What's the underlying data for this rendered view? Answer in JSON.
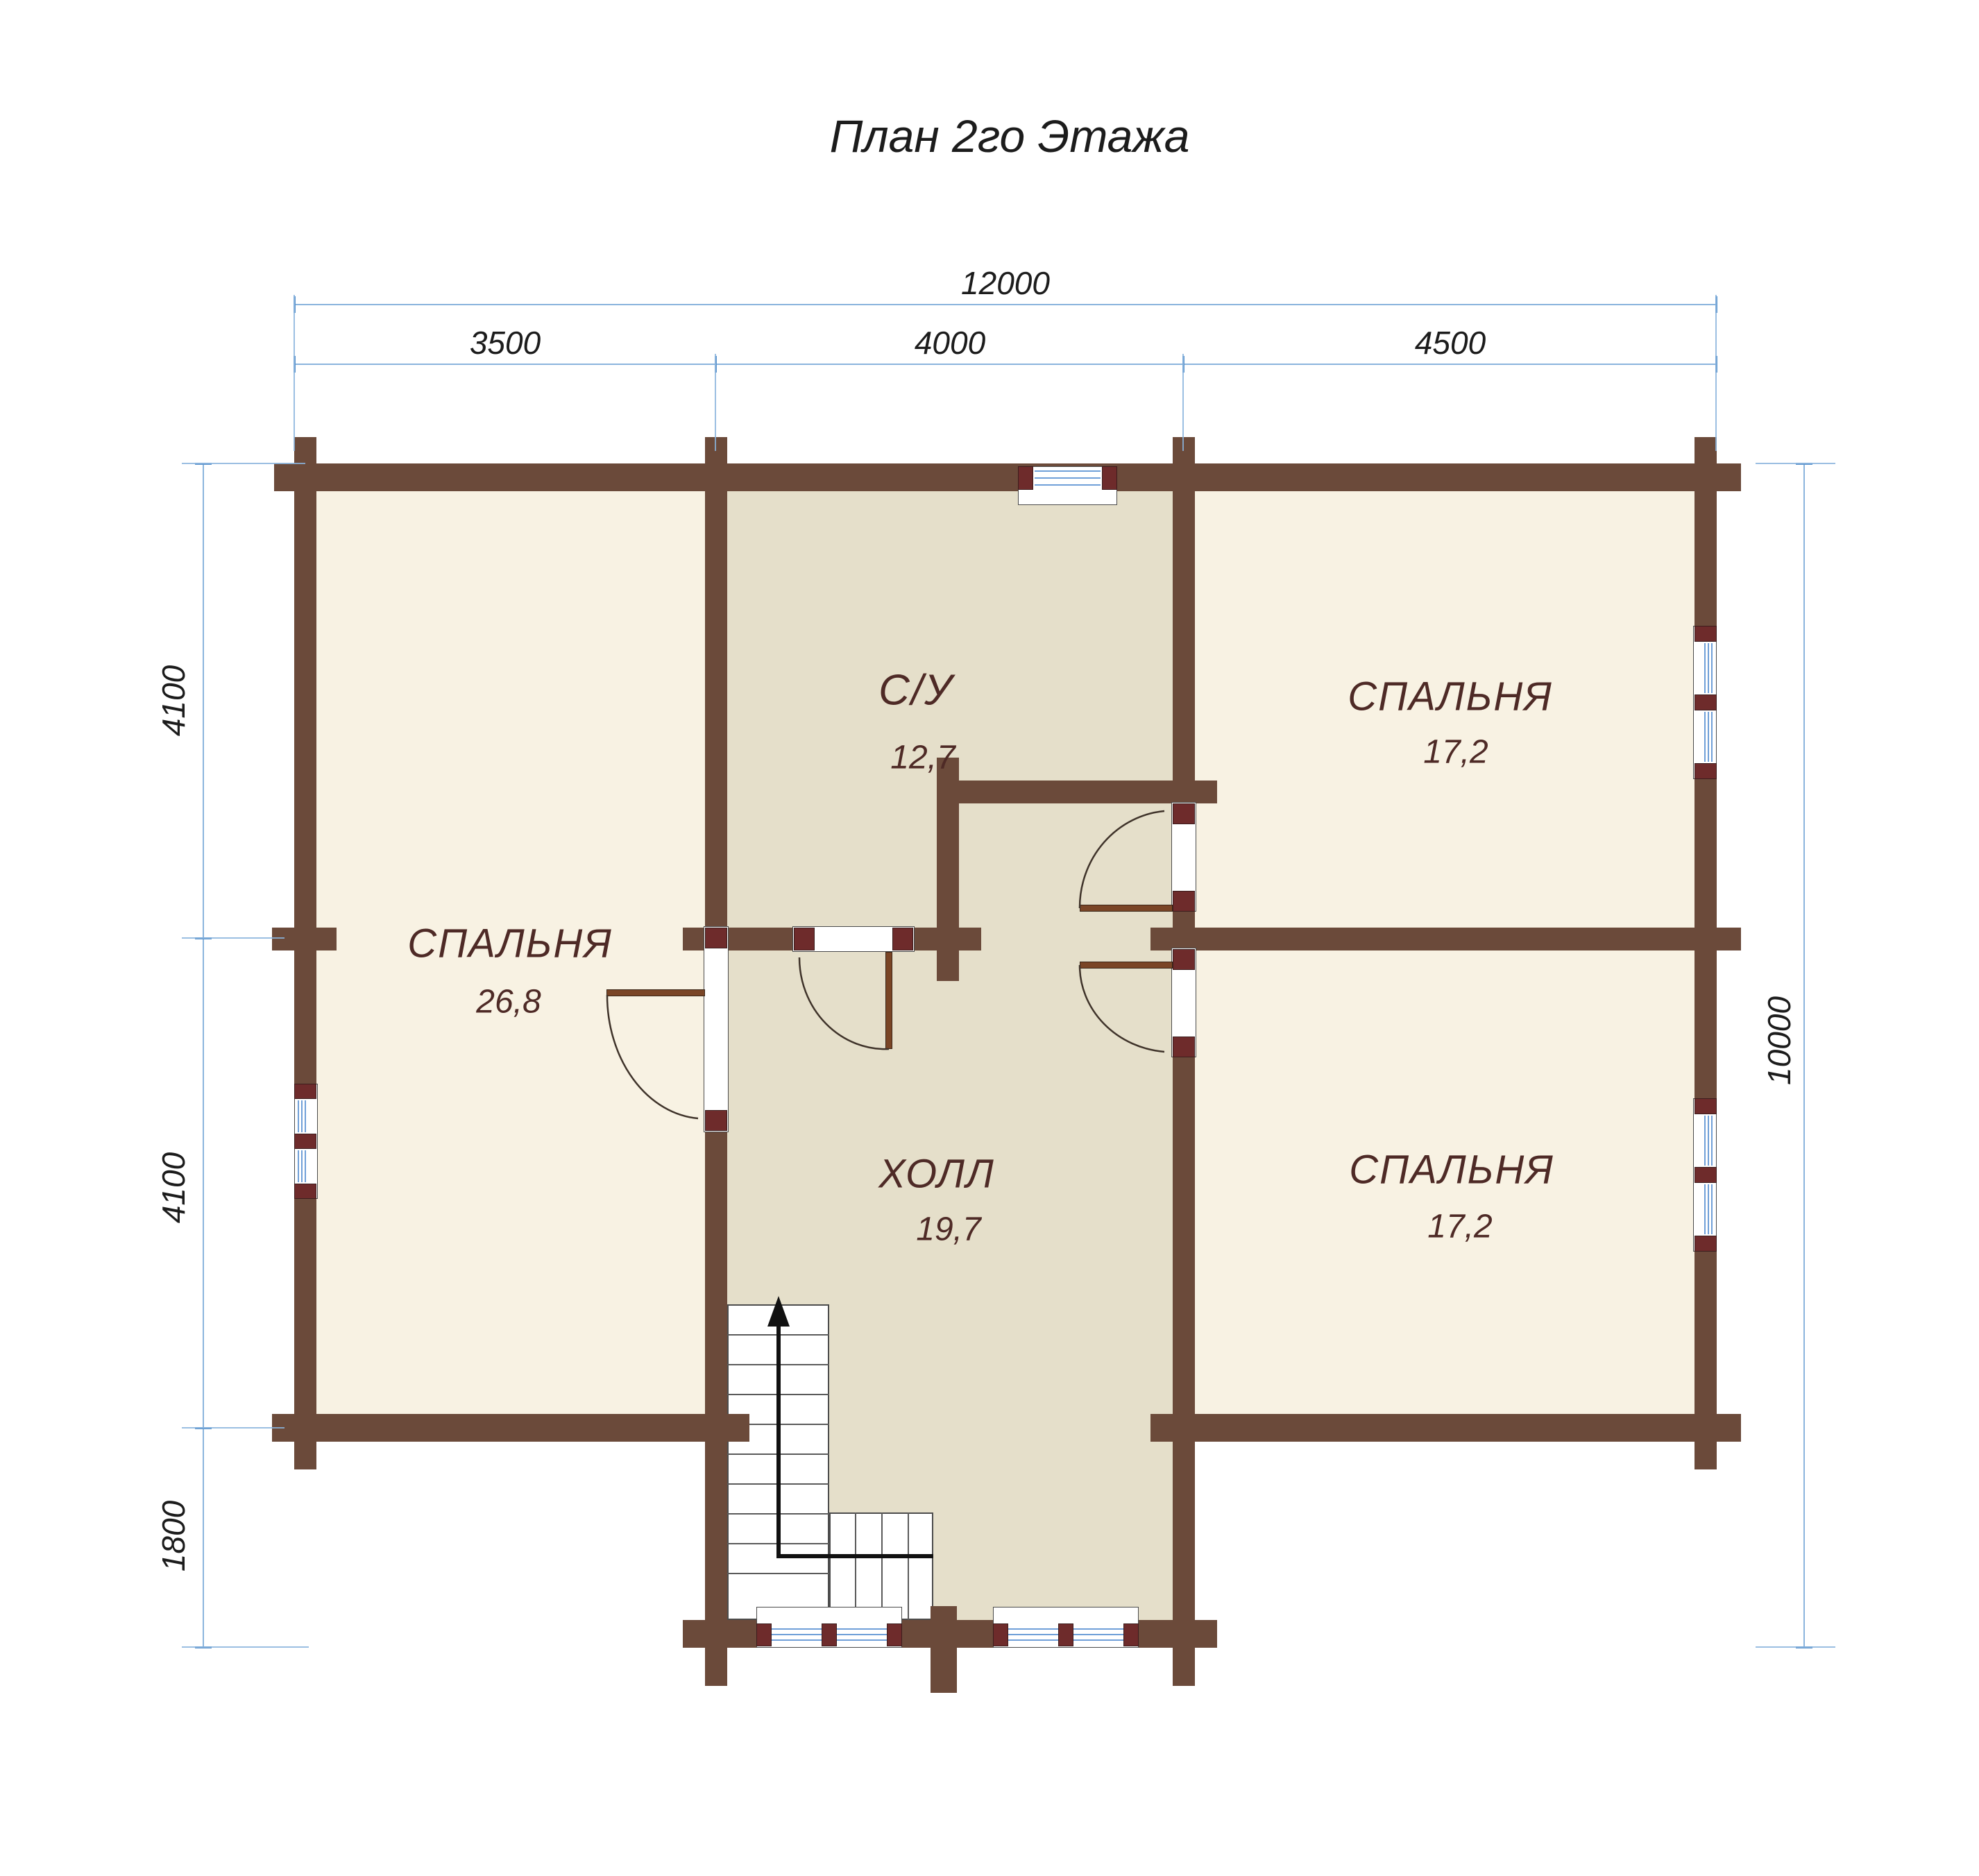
{
  "title": "План 2го Этажа",
  "dimensions": {
    "total_width": "12000",
    "top_segments": [
      "3500",
      "4000",
      "4500"
    ],
    "left_segments": [
      "4100",
      "4100",
      "1800"
    ],
    "right_total": "10000"
  },
  "rooms": [
    {
      "name": "С/У",
      "area": "12,7"
    },
    {
      "name": "СПАЛЬНЯ",
      "area": "17,2"
    },
    {
      "name": "СПАЛЬНЯ",
      "area": "26,8"
    },
    {
      "name": "ХОЛЛ",
      "area": "19,7"
    },
    {
      "name": "СПАЛЬНЯ",
      "area": "17,2"
    }
  ],
  "icons": {
    "stairs_arrow": "up-arrow"
  },
  "colors": {
    "wall": "#6b4a3a",
    "window_block": "#6e2b2b",
    "room_light": "#f8f2e3",
    "room_dark": "#e5dfca",
    "glass": "#6f9fd8",
    "dim_line": "#8ab4dd",
    "dim_tick": "#5d94cc",
    "label": "#4e2a26",
    "door_leaf": "#7a4526"
  }
}
